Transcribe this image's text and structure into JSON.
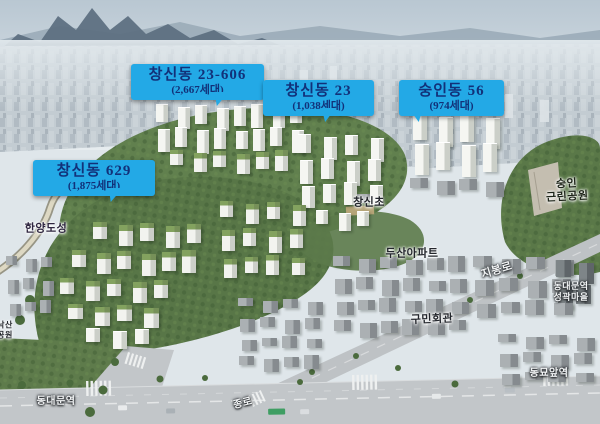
{
  "colors": {
    "callout_bg": "#23a9e6",
    "callout_text": "#123179"
  },
  "callouts": [
    {
      "title": "창신동 23-606",
      "subtitle": "(2,667세대)"
    },
    {
      "title": "창신동 23",
      "subtitle": "(1,038세대)"
    },
    {
      "title": "숭인동 56",
      "subtitle": "(974세대)"
    },
    {
      "title": "창신동 629",
      "subtitle": "(1,875세대)"
    }
  ],
  "place_labels": {
    "hanyang_doseong": "한양도성",
    "naksan_line1": "낙산",
    "naksan_line2": "공원",
    "changsin_elementary": "창신초",
    "doosan_apartment": "두산아파트",
    "gumin_hall": "구민회관",
    "jibong_ro": "지봉로",
    "sungin_park_line1": "숭인",
    "sungin_park_line2": "근린공원",
    "seonggwak_line1": "동대문역",
    "seonggwak_line2": "성곽마을",
    "dongmyo_station": "동묘앞역",
    "dongdaemun_station": "동대문역",
    "jongno": "종로"
  }
}
